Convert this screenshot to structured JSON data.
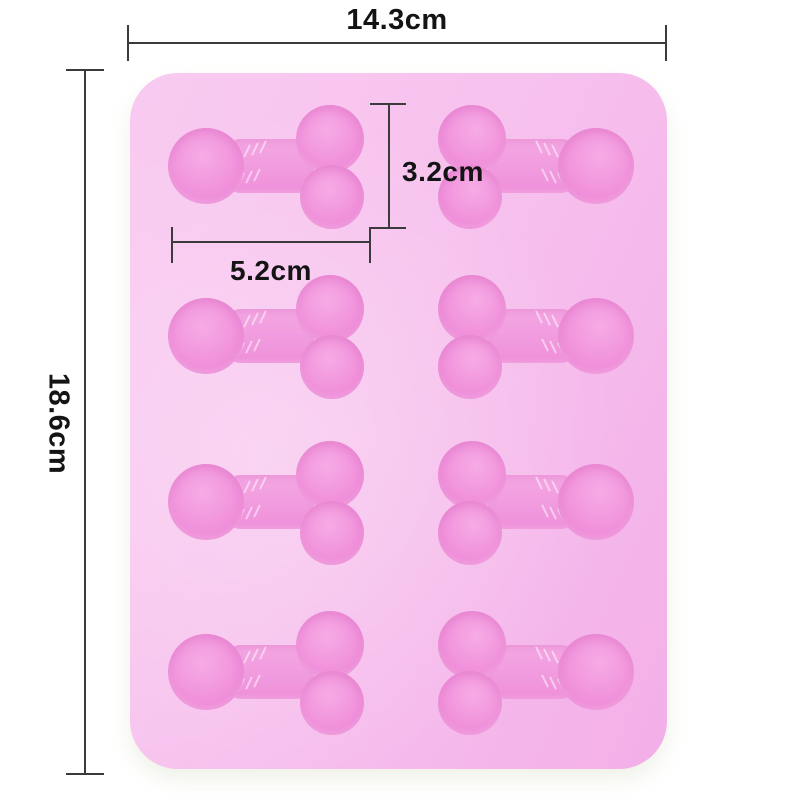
{
  "scene": {
    "description": "Product photo of a pink 8-cavity silicone novelty mold with dimension callouts",
    "background_color": "#ffffff"
  },
  "annotations": {
    "overall_width": "14.3cm",
    "overall_height": "18.6cm",
    "cavity_height": "3.2cm",
    "cavity_length": "5.2cm",
    "line_color": "#3b3b3b",
    "text_color": "#141414"
  },
  "mold": {
    "rows": 4,
    "columns": 2,
    "cavity_count": 8,
    "body_color": "#f7c2ee",
    "body_highlight": "#f9cbf1",
    "body_shadow": "#f3afe8",
    "cavity_color": "#f193dc",
    "cavity_rim_color": "#ec81d5",
    "cavity_highlight": "#f6abe5"
  }
}
